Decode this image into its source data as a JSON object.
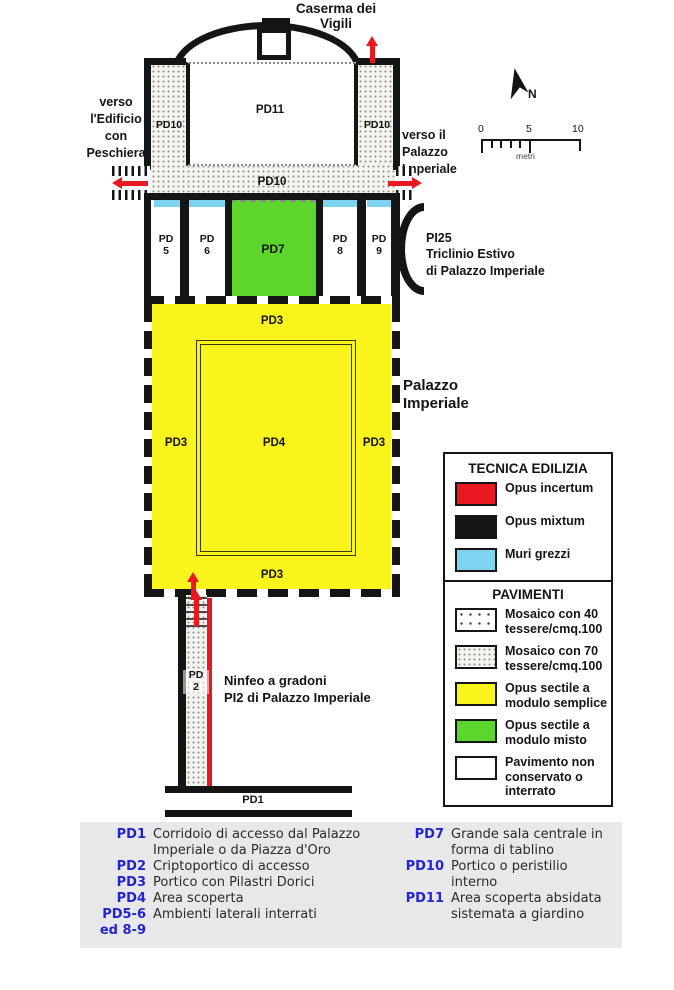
{
  "title_area": {
    "caserma": "Caserma dei\nVigili",
    "verso_left": "verso\nl'Edificio\ncon\nPeschiera",
    "verso_right": "verso il\nPalazzo\nImperiale"
  },
  "compass": {
    "n_label": "N"
  },
  "scalebar": {
    "tick0": "0",
    "tick5": "5",
    "tick10": "10",
    "unit": "metri"
  },
  "plan": {
    "pd11": "PD11",
    "pd10_left": "PD10",
    "pd10_right": "PD10",
    "pd10_bottom": "PD10",
    "pd5": "PD\n5",
    "pd6": "PD\n6",
    "pd7": "PD7",
    "pd8": "PD\n8",
    "pd9": "PD\n9",
    "pi25": "PI25\nTriclinio Estivo\ndi Palazzo Imperiale",
    "pd3_top": "PD3",
    "pd3_left": "PD3",
    "pd3_right": "PD3",
    "pd3_bottom": "PD3",
    "pd4": "PD4",
    "palazzo_imperiale": "Palazzo\nImperiale",
    "ninfeo": "Ninfeo a gradoni\nPI2 di Palazzo Imperiale",
    "pd2": "PD\n2",
    "pd1": "PD1"
  },
  "colors": {
    "red": "#e8191f",
    "black_wall": "#151515",
    "cyan": "#7ed3f0",
    "yellow": "#f8f41c",
    "green": "#5cd62c",
    "caption_blue": "#2424cf",
    "caption_bg": "#e8e8ea"
  },
  "legend": {
    "tecnica": {
      "title": "TECNICA EDILIZIA",
      "items": [
        {
          "label": "Opus incertum",
          "color": "#e8191f"
        },
        {
          "label": "Opus mixtum",
          "color": "#151515"
        },
        {
          "label": "Muri grezzi",
          "color": "#7ed3f0"
        }
      ]
    },
    "pavimenti": {
      "title": "PAVIMENTI",
      "items": [
        {
          "label": "Mosaico con 40\ntessere/cmq.100",
          "pattern": "dots-40"
        },
        {
          "label": "Mosaico con 70\ntessere/cmq.100",
          "pattern": "dots-70"
        },
        {
          "label": "Opus sectile a\nmodulo semplice",
          "color": "#f8f41c"
        },
        {
          "label": "Opus sectile a\nmodulo misto",
          "color": "#5cd62c"
        },
        {
          "label": "Pavimento non\nconservato o\ninterrato",
          "color": "#ffffff"
        }
      ]
    }
  },
  "caption": {
    "left": [
      {
        "code": "PD1",
        "desc": "Corridoio di accesso dal Palazzo Imperiale o da Piazza d'Oro"
      },
      {
        "code": "PD2",
        "desc": "Criptoportico di accesso"
      },
      {
        "code": "PD3",
        "desc": "Portico con Pilastri Dorici"
      },
      {
        "code": "PD4",
        "desc": "Area scoperta"
      },
      {
        "code": "PD5-6\ned 8-9",
        "desc": "Ambienti laterali interrati"
      }
    ],
    "right": [
      {
        "code": "PD7",
        "desc": "Grande sala centrale in forma di tablino"
      },
      {
        "code": "PD10",
        "desc": "Portico o peristilio interno"
      },
      {
        "code": "PD11",
        "desc": "Area scoperta absidata sistemata a giardino"
      }
    ]
  }
}
